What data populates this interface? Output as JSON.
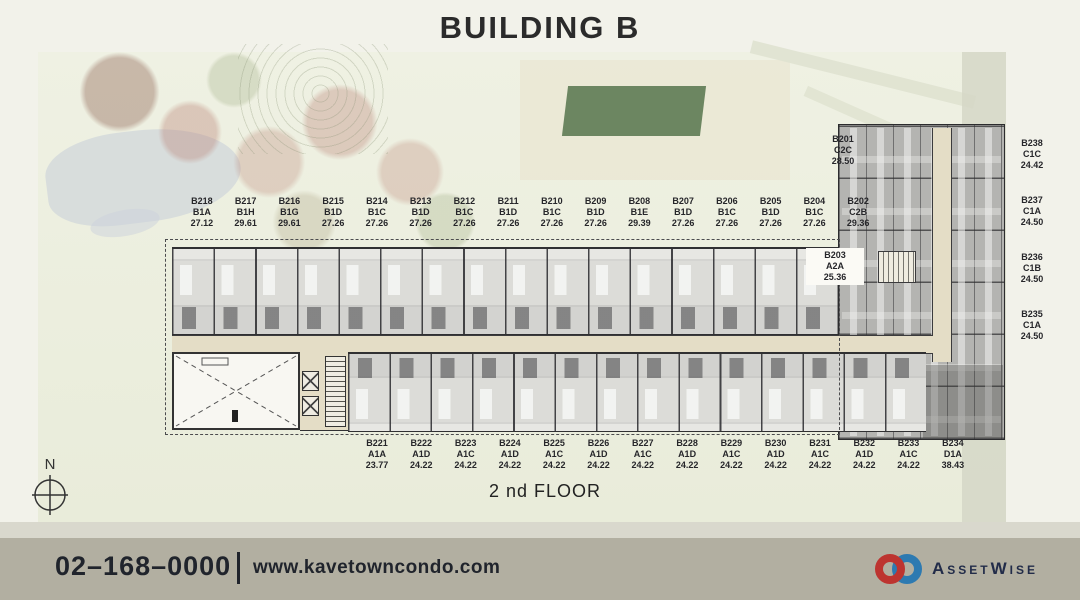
{
  "title": "BUILDING B",
  "floor_label": "2 nd FLOOR",
  "compass": {
    "north_label": "N"
  },
  "units": {
    "top": [
      {
        "id": "B218",
        "type": "B1A",
        "area": "27.12"
      },
      {
        "id": "B217",
        "type": "B1H",
        "area": "29.61"
      },
      {
        "id": "B216",
        "type": "B1G",
        "area": "29.61"
      },
      {
        "id": "B215",
        "type": "B1D",
        "area": "27.26"
      },
      {
        "id": "B214",
        "type": "B1C",
        "area": "27.26"
      },
      {
        "id": "B213",
        "type": "B1D",
        "area": "27.26"
      },
      {
        "id": "B212",
        "type": "B1C",
        "area": "27.26"
      },
      {
        "id": "B211",
        "type": "B1D",
        "area": "27.26"
      },
      {
        "id": "B210",
        "type": "B1C",
        "area": "27.26"
      },
      {
        "id": "B209",
        "type": "B1D",
        "area": "27.26"
      },
      {
        "id": "B208",
        "type": "B1E",
        "area": "29.39"
      },
      {
        "id": "B207",
        "type": "B1D",
        "area": "27.26"
      },
      {
        "id": "B206",
        "type": "B1C",
        "area": "27.26"
      },
      {
        "id": "B205",
        "type": "B1D",
        "area": "27.26"
      },
      {
        "id": "B204",
        "type": "B1C",
        "area": "27.26"
      },
      {
        "id": "B202",
        "type": "C2B",
        "area": "29.36"
      }
    ],
    "bottom": [
      {
        "id": "B221",
        "type": "A1A",
        "area": "23.77"
      },
      {
        "id": "B222",
        "type": "A1D",
        "area": "24.22"
      },
      {
        "id": "B223",
        "type": "A1C",
        "area": "24.22"
      },
      {
        "id": "B224",
        "type": "A1D",
        "area": "24.22"
      },
      {
        "id": "B225",
        "type": "A1C",
        "area": "24.22"
      },
      {
        "id": "B226",
        "type": "A1D",
        "area": "24.22"
      },
      {
        "id": "B227",
        "type": "A1C",
        "area": "24.22"
      },
      {
        "id": "B228",
        "type": "A1D",
        "area": "24.22"
      },
      {
        "id": "B229",
        "type": "A1C",
        "area": "24.22"
      },
      {
        "id": "B230",
        "type": "A1D",
        "area": "24.22"
      },
      {
        "id": "B231",
        "type": "A1C",
        "area": "24.22"
      },
      {
        "id": "B232",
        "type": "A1D",
        "area": "24.22"
      },
      {
        "id": "B233",
        "type": "A1C",
        "area": "24.22"
      },
      {
        "id": "B234",
        "type": "D1A",
        "area": "38.43"
      }
    ],
    "right": [
      {
        "id": "B238",
        "type": "C1C",
        "area": "24.42"
      },
      {
        "id": "B237",
        "type": "C1A",
        "area": "24.50"
      },
      {
        "id": "B236",
        "type": "C1B",
        "area": "24.50"
      },
      {
        "id": "B235",
        "type": "C1A",
        "area": "24.50"
      }
    ],
    "b201": {
      "id": "B201",
      "type": "C2C",
      "area": "28.50"
    },
    "b203": {
      "id": "B203",
      "type": "A2A",
      "area": "25.36"
    }
  },
  "footer": {
    "phone": "02–168–0000",
    "website": "www.kavetowncondo.com",
    "brand": "AssetWise"
  },
  "colors": {
    "footer_bar": "#b2afa1",
    "footer_text": "#20242c",
    "corridor_beige": "#e4ddc6",
    "logo_red": "#bd3430",
    "logo_blue": "#2d7ab1",
    "brand_navy": "#222c49"
  }
}
